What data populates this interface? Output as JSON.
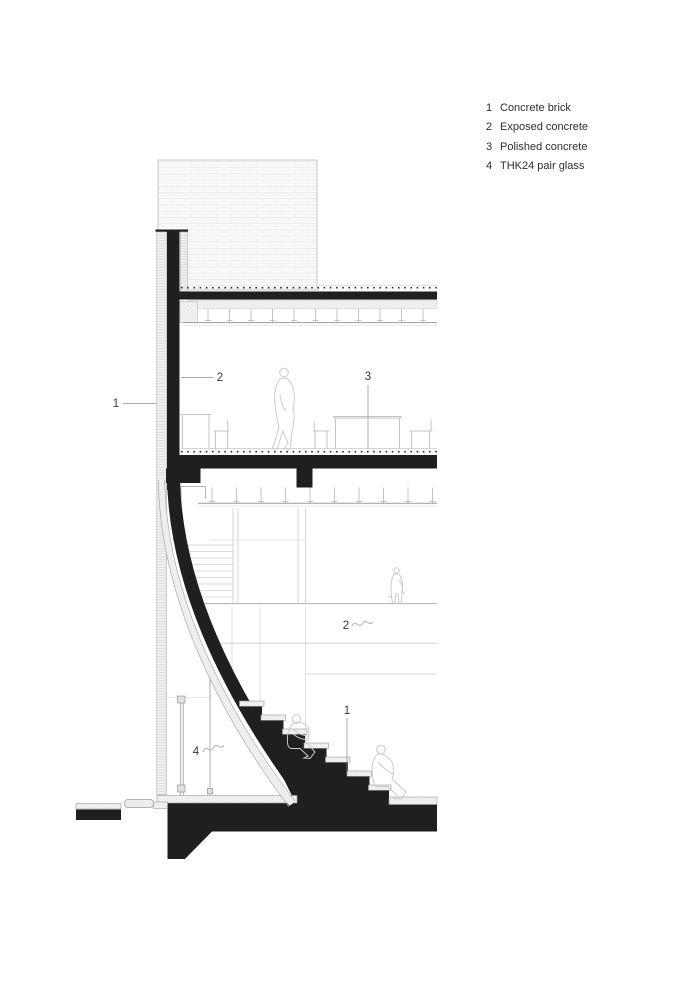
{
  "drawing": {
    "kind": "architectural-section",
    "ink_color": "#1f1f1f",
    "light_line_color": "#c9c9c9",
    "annotation_color": "#3a3a3a"
  },
  "legend": {
    "items": [
      {
        "num": "1",
        "label": "Concrete brick"
      },
      {
        "num": "2",
        "label": "Exposed concrete"
      },
      {
        "num": "3",
        "label": "Polished concrete"
      },
      {
        "num": "4",
        "label": "THK24 pair glass"
      }
    ]
  },
  "callouts": {
    "facade_brick": "1",
    "wall_concrete": "2",
    "floor_polished": "3",
    "hall_concrete": "2",
    "stair_brick": "1",
    "pair_glass": "4"
  }
}
